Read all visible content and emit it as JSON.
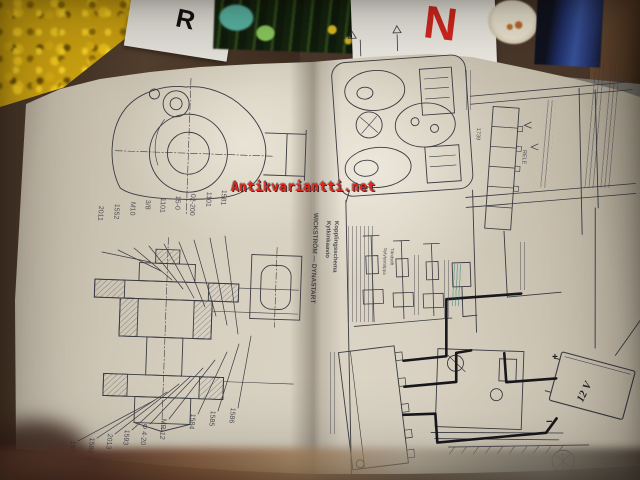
{
  "watermark": {
    "text": "Antikvariantti.net",
    "color": "#e02a1c"
  },
  "background": {
    "magazine_letter_r": "R",
    "magazine_letter_n": "N"
  },
  "left_page": {
    "labels_top": [
      "2011",
      "1552",
      "M10",
      "3/8",
      "1101",
      "15-0",
      "02-200",
      "1101",
      "1581"
    ],
    "labels_bottom": [
      "1592",
      "1588",
      "2013",
      "1593",
      "Φ 4·20",
      "MR-12",
      "1584",
      "1585",
      "1586"
    ]
  },
  "right_page": {
    "heading": "WICKSTRÖM — DYNASTART",
    "subheading_fi": "Kytkinkaavio",
    "subheading_sv": "Kopplingsschema",
    "relay_number": "1739",
    "relay_word": "RELE",
    "spark_plug_fi": "Sytytystulppa",
    "spark_plug_sv": "Tändstift",
    "battery_label": "12 V",
    "battery_plus": "+",
    "battery_minus": "−"
  }
}
